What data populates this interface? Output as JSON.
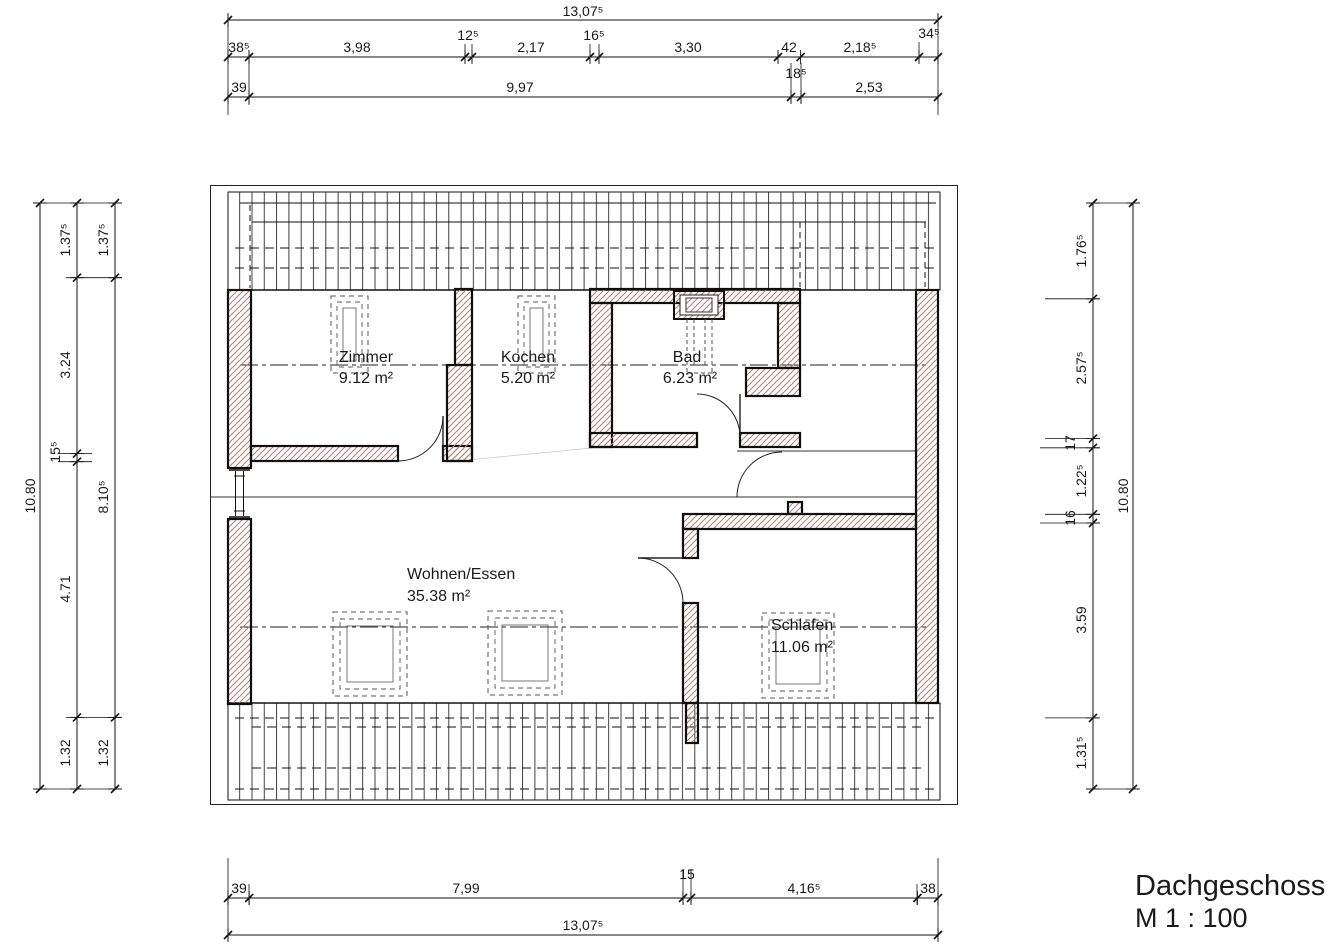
{
  "title": {
    "name": "Dachgeschoss",
    "scale": "M 1 : 100"
  },
  "rooms": [
    {
      "name": "Zimmer",
      "area": "9.12 m²"
    },
    {
      "name": "Kochen",
      "area": "5.20 m²"
    },
    {
      "name": "Bad",
      "area": "6.23 m²"
    },
    {
      "name": "Wohnen/Essen",
      "area": "35.38 m²"
    },
    {
      "name": "Schlafen",
      "area": "11.06 m²"
    }
  ],
  "dims": {
    "top_total": "13,07⁵",
    "top_chain": [
      "38⁵",
      "3,98",
      "12⁵",
      "2,17",
      "16⁵",
      "3,30",
      "42",
      "2,18⁵",
      "34⁵"
    ],
    "top_sub": "18⁵",
    "top_chain2": [
      "39",
      "9,97",
      "2,53"
    ],
    "bottom_chain": [
      "39",
      "7,99",
      "15",
      "4,16⁵",
      "38"
    ],
    "bottom_total": "13,07⁵",
    "left_total": "10.80",
    "left_chain_a": [
      "1.37⁵",
      "3.24",
      "15⁵",
      "4.71",
      "1.32"
    ],
    "left_chain_b": [
      "1.37⁵",
      "8.10⁵",
      "1.32"
    ],
    "right_chain": [
      "1.76⁵",
      "2.57⁵",
      "17",
      "1.22⁵",
      "16",
      "3.59",
      "1.31⁵"
    ],
    "right_total": "10.80"
  },
  "colors": {
    "wall_hatch": "#b5837a",
    "line": "#111111"
  }
}
